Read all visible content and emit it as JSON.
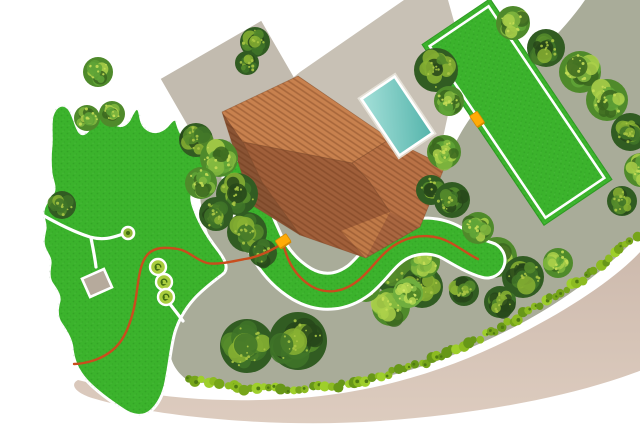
{
  "meta": {
    "title": "Garden property plan"
  },
  "palette": {
    "background": "#ffffff",
    "lawn_green": "#3bb32c",
    "lawn_border": "#ffffff",
    "ground": "#a9ac99",
    "ground_deep": "#a0a48f",
    "patio": "#c8c1b5",
    "outbuilding": "#c2bbaf",
    "driveway_top": "#cdbaad",
    "driveway_bottom": "#ddccbf",
    "pool_light": "#a5e0d9",
    "pool_dark": "#54b4ab",
    "roof": {
      "base": "#a96640",
      "ne": "#c8814e",
      "sw": "#8a5434",
      "lower": "#a05f3a",
      "wing": "#b97246",
      "tip": "#c07a48",
      "seam": "#7c4a2b",
      "stripe": "rgba(90,40,12,0.30)"
    },
    "wire": "#c94d1d",
    "station": "#ffab07",
    "station_border": "#d68a00",
    "hedge": [
      "#8cbb21",
      "#76a51a",
      "#9ecf2b",
      "#679718"
    ],
    "hedge_dot": "#4e7a12",
    "shed_fill": "#b6aa9c",
    "plant_fill": "#a9cd3d",
    "plant_glyph": "#3f6c12",
    "node_fill": "#8db832",
    "path_white": "#ffffff",
    "tree": {
      "d": {
        "base": "#315c22",
        "blobs": [
          "#3f7428",
          "#27471a",
          "#568c2c",
          "#88b132"
        ],
        "speck": "#a9c544"
      },
      "m": {
        "base": "#4f8a2b",
        "blobs": [
          "#60a437",
          "#3a661f",
          "#83b83f",
          "#abd04a"
        ],
        "speck": "#c4dd55"
      },
      "l": {
        "base": "#6fae3e",
        "blobs": [
          "#8cc24a",
          "#4f8527",
          "#b8da55",
          "#5e9a31"
        ],
        "speck": "#d3e868"
      }
    }
  },
  "scene": {
    "ground": {
      "d": "M 640,0 L 585,0 C 560,36 534,56 508,78 C 484,98 468,118 456,142 L 436,172 L 222,132 C 208,142 201,162 200,185 C 199,208 206,232 216,252 C 223,267 212,278 199,287 C 186,297 176,311 171,331 C 167,350 170,367 186,379 C 235,392 295,393 355,383 C 415,373 470,350 520,324 C 562,302 600,273 625,249 C 634,240 640,234 641,230 Z"
    },
    "driveway": {
      "d": "M 78,380 C 150,398 220,404 300,398 C 380,392 455,368 520,334 C 575,306 618,276 642,250 L 642,370 C 575,396 480,414 380,421 C 280,428 160,418 92,398 C 74,392 70,384 78,380 Z"
    },
    "patio": {
      "d": "M 404,0 L 448,0 L 462,50 L 436,170 L 224,134 L 300,72 Z"
    },
    "outbuilding": {
      "x": 233,
      "y": 88,
      "rot": -30,
      "w": 116,
      "h": 88
    },
    "paddock": {
      "x": 517,
      "y": 112,
      "rot": -34,
      "w": 82,
      "h": 218,
      "inset": 5.5
    },
    "strip": {
      "d": "M 241,178 C 249,200 253,218 261,234 C 269,254 282,272 302,284 C 323,296 343,292 359,280 C 374,268 382,251 400,242 C 418,233 438,235 452,243 C 464,250 476,257 487,260",
      "width": 33
    },
    "lawn_main": {
      "d": "M 52,116 C 56,104 64,102 70,110 C 74,116 75,124 79,131 C 84,139 90,128 95,119 C 100,111 108,112 113,120 C 117,127 123,128 129,120 C 133,112 136,105 139,110 C 141,114 140,123 146,128 C 153,134 161,132 167,126 C 171,121 175,116 177,122 C 179,128 180,135 188,139 C 198,144 208,151 212,162 C 215,172 210,181 200,186 C 192,190 190,196 193,205 C 198,221 207,236 217,249 C 224,258 230,268 223,274 C 214,281 203,289 194,299 C 186,308 179,319 175,332 C 171,346 170,361 167,376 C 165,390 160,403 151,411 C 143,418 132,416 122,409 C 109,400 96,391 86,380 C 78,371 73,360 72,348 C 71,339 66,331 61,324 C 56,317 57,308 59,301 C 60,295 56,290 52,284 C 48,278 49,271 50,264 C 51,258 46,253 44,247 C 42,241 44,235 45,229 C 46,223 42,218 43,211 C 44,203 50,199 53,193 C 56,187 52,181 51,173 C 50,164 50,155 51,146 C 52,136 50,126 52,116 Z"
    },
    "garden_paths": [
      "M 39,213 C 58,224 74,232 90,237 C 104,241 114,237 123,234",
      "M 91,238 C 93,248 95,258 96,267",
      "M 170,304 L 183,321"
    ],
    "shed": {
      "x": 97,
      "y": 283,
      "rot": -24,
      "w": 24,
      "h": 20
    },
    "node": {
      "x": 128,
      "y": 233,
      "r": 6
    },
    "plants": {
      "r": 8,
      "glyph": "M 2.8,0 A 2.8,2.8 0 1 0 0,2.8 A 1.6,1.6 0 1 1 -1.6,0",
      "items": [
        [
          158,
          267
        ],
        [
          164,
          282
        ],
        [
          166,
          297
        ]
      ]
    },
    "house": {
      "outline": "222,112 298,76 390,139 445,166 420,227 366,258 300,235 252,205",
      "facets": [
        {
          "pts": "222,112 298,76 390,139 352,163 243,142",
          "key": "ne"
        },
        {
          "pts": "222,112 243,142 262,182 300,235 252,205",
          "key": "sw"
        },
        {
          "pts": "243,142 352,163 369,181 390,212 366,258 300,235 262,182",
          "key": "lower"
        },
        {
          "pts": "352,163 390,139 445,166 420,227 390,212 369,181",
          "key": "wing"
        },
        {
          "pts": "390,212 366,258 341,231",
          "key": "tip"
        }
      ],
      "seams": [
        [
          243,
          142,
          352,
          163
        ],
        [
          352,
          163,
          390,
          139
        ],
        [
          352,
          163,
          369,
          181
        ],
        [
          369,
          181,
          390,
          212
        ],
        [
          262,
          182,
          243,
          142
        ],
        [
          300,
          235,
          262,
          182
        ]
      ]
    },
    "pool": {
      "x": 397,
      "y": 116,
      "rot": -34,
      "w": 40,
      "h": 68
    },
    "hedge": {
      "points": [
        [
          190,
          378
        ],
        [
          245,
          388
        ],
        [
          300,
          390
        ],
        [
          355,
          383
        ],
        [
          410,
          368
        ],
        [
          458,
          348
        ],
        [
          502,
          327
        ],
        [
          546,
          302
        ],
        [
          586,
          276
        ],
        [
          618,
          251
        ],
        [
          640,
          232
        ]
      ]
    },
    "wire": {
      "segments": [
        "M 283,243 C 287,261 295,276 311,286 C 328,296 346,291 360,279 C 374,267 382,251 400,242 C 418,233 437,235 451,243 C 462,249 471,256 478,259",
        "M 283,243 C 271,251 258,257 245,259 C 230,262 216,265 207,263 C 196,260 189,251 178,249 C 165,247 155,247 148,254 C 141,261 139,275 137,290 C 135,307 131,323 124,336 C 117,349 106,356 95,360 C 86,363 78,364 74,364"
      ]
    },
    "stations": [
      {
        "x": 283,
        "y": 241,
        "w": 13,
        "h": 9
      },
      {
        "x": 477,
        "y": 119,
        "w": 9,
        "h": 13
      }
    ],
    "trees": [
      {
        "x": 98,
        "y": 72,
        "r": 15,
        "tone": "m"
      },
      {
        "x": 87,
        "y": 118,
        "r": 13,
        "tone": "m"
      },
      {
        "x": 112,
        "y": 114,
        "r": 13,
        "tone": "m"
      },
      {
        "x": 255,
        "y": 42,
        "r": 15,
        "tone": "d"
      },
      {
        "x": 247,
        "y": 63,
        "r": 12,
        "tone": "d"
      },
      {
        "x": 62,
        "y": 205,
        "r": 14,
        "tone": "d"
      },
      {
        "x": 196,
        "y": 140,
        "r": 17,
        "tone": "d"
      },
      {
        "x": 219,
        "y": 158,
        "r": 19,
        "tone": "m"
      },
      {
        "x": 201,
        "y": 183,
        "r": 16,
        "tone": "m"
      },
      {
        "x": 237,
        "y": 194,
        "r": 21,
        "tone": "d"
      },
      {
        "x": 216,
        "y": 214,
        "r": 17,
        "tone": "d"
      },
      {
        "x": 247,
        "y": 232,
        "r": 20,
        "tone": "d"
      },
      {
        "x": 263,
        "y": 253,
        "r": 14,
        "tone": "d"
      },
      {
        "x": 436,
        "y": 70,
        "r": 22,
        "tone": "d"
      },
      {
        "x": 449,
        "y": 101,
        "r": 15,
        "tone": "m"
      },
      {
        "x": 444,
        "y": 152,
        "r": 17,
        "tone": "m"
      },
      {
        "x": 431,
        "y": 190,
        "r": 15,
        "tone": "d"
      },
      {
        "x": 452,
        "y": 200,
        "r": 18,
        "tone": "d"
      },
      {
        "x": 478,
        "y": 228,
        "r": 16,
        "tone": "m"
      },
      {
        "x": 513,
        "y": 23,
        "r": 17,
        "tone": "m"
      },
      {
        "x": 546,
        "y": 48,
        "r": 19,
        "tone": "d"
      },
      {
        "x": 580,
        "y": 72,
        "r": 21,
        "tone": "m"
      },
      {
        "x": 607,
        "y": 100,
        "r": 21,
        "tone": "m"
      },
      {
        "x": 630,
        "y": 132,
        "r": 19,
        "tone": "d"
      },
      {
        "x": 641,
        "y": 170,
        "r": 17,
        "tone": "m"
      },
      {
        "x": 622,
        "y": 201,
        "r": 15,
        "tone": "d"
      },
      {
        "x": 394,
        "y": 268,
        "r": 25,
        "tone": "d",
        "under": true
      },
      {
        "x": 422,
        "y": 287,
        "r": 21,
        "tone": "d",
        "under": true
      },
      {
        "x": 391,
        "y": 307,
        "r": 19,
        "tone": "m",
        "under": true
      },
      {
        "x": 424,
        "y": 262,
        "r": 16,
        "tone": "m",
        "under": true
      },
      {
        "x": 366,
        "y": 288,
        "r": 14,
        "tone": "m",
        "under": true
      },
      {
        "x": 408,
        "y": 293,
        "r": 15,
        "tone": "l",
        "under": true
      },
      {
        "x": 497,
        "y": 257,
        "r": 20,
        "tone": "m",
        "under": true
      },
      {
        "x": 523,
        "y": 277,
        "r": 21,
        "tone": "d",
        "under": true
      },
      {
        "x": 500,
        "y": 302,
        "r": 16,
        "tone": "d",
        "under": true
      },
      {
        "x": 464,
        "y": 291,
        "r": 15,
        "tone": "d",
        "under": true
      },
      {
        "x": 558,
        "y": 263,
        "r": 15,
        "tone": "m",
        "under": true
      },
      {
        "x": 247,
        "y": 346,
        "r": 27,
        "tone": "d"
      },
      {
        "x": 298,
        "y": 341,
        "r": 29,
        "tone": "d"
      }
    ]
  }
}
